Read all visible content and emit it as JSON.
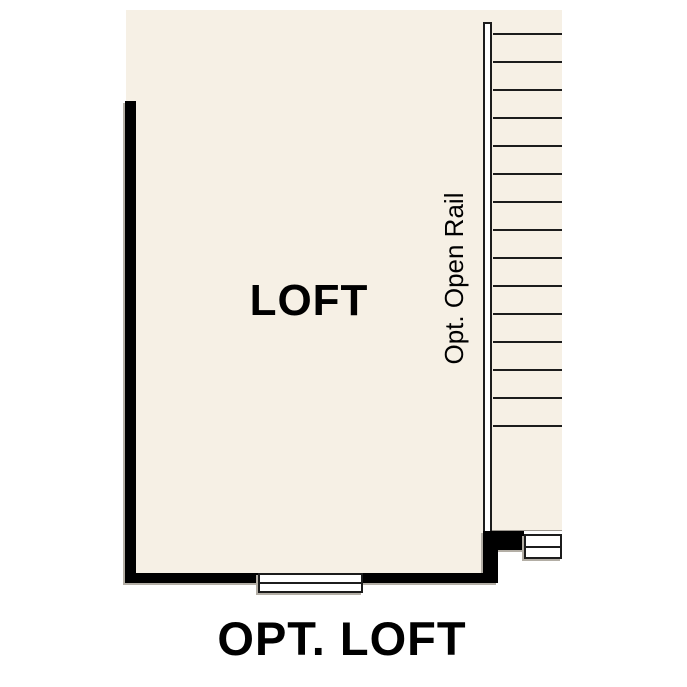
{
  "plan": {
    "room_label": "LOFT",
    "rail_label": "Opt. Open Rail",
    "caption": "OPT. LOFT",
    "colors": {
      "floor": "#f6f0e5",
      "wall": "#000000",
      "line": "#1c1c1c",
      "rail_fill": "#ffffff",
      "shadow": "#b3aea5",
      "background": "#ffffff"
    },
    "stairs": {
      "tread_count": 15,
      "tread_start_offset": 23,
      "tread_spacing": 28
    }
  }
}
